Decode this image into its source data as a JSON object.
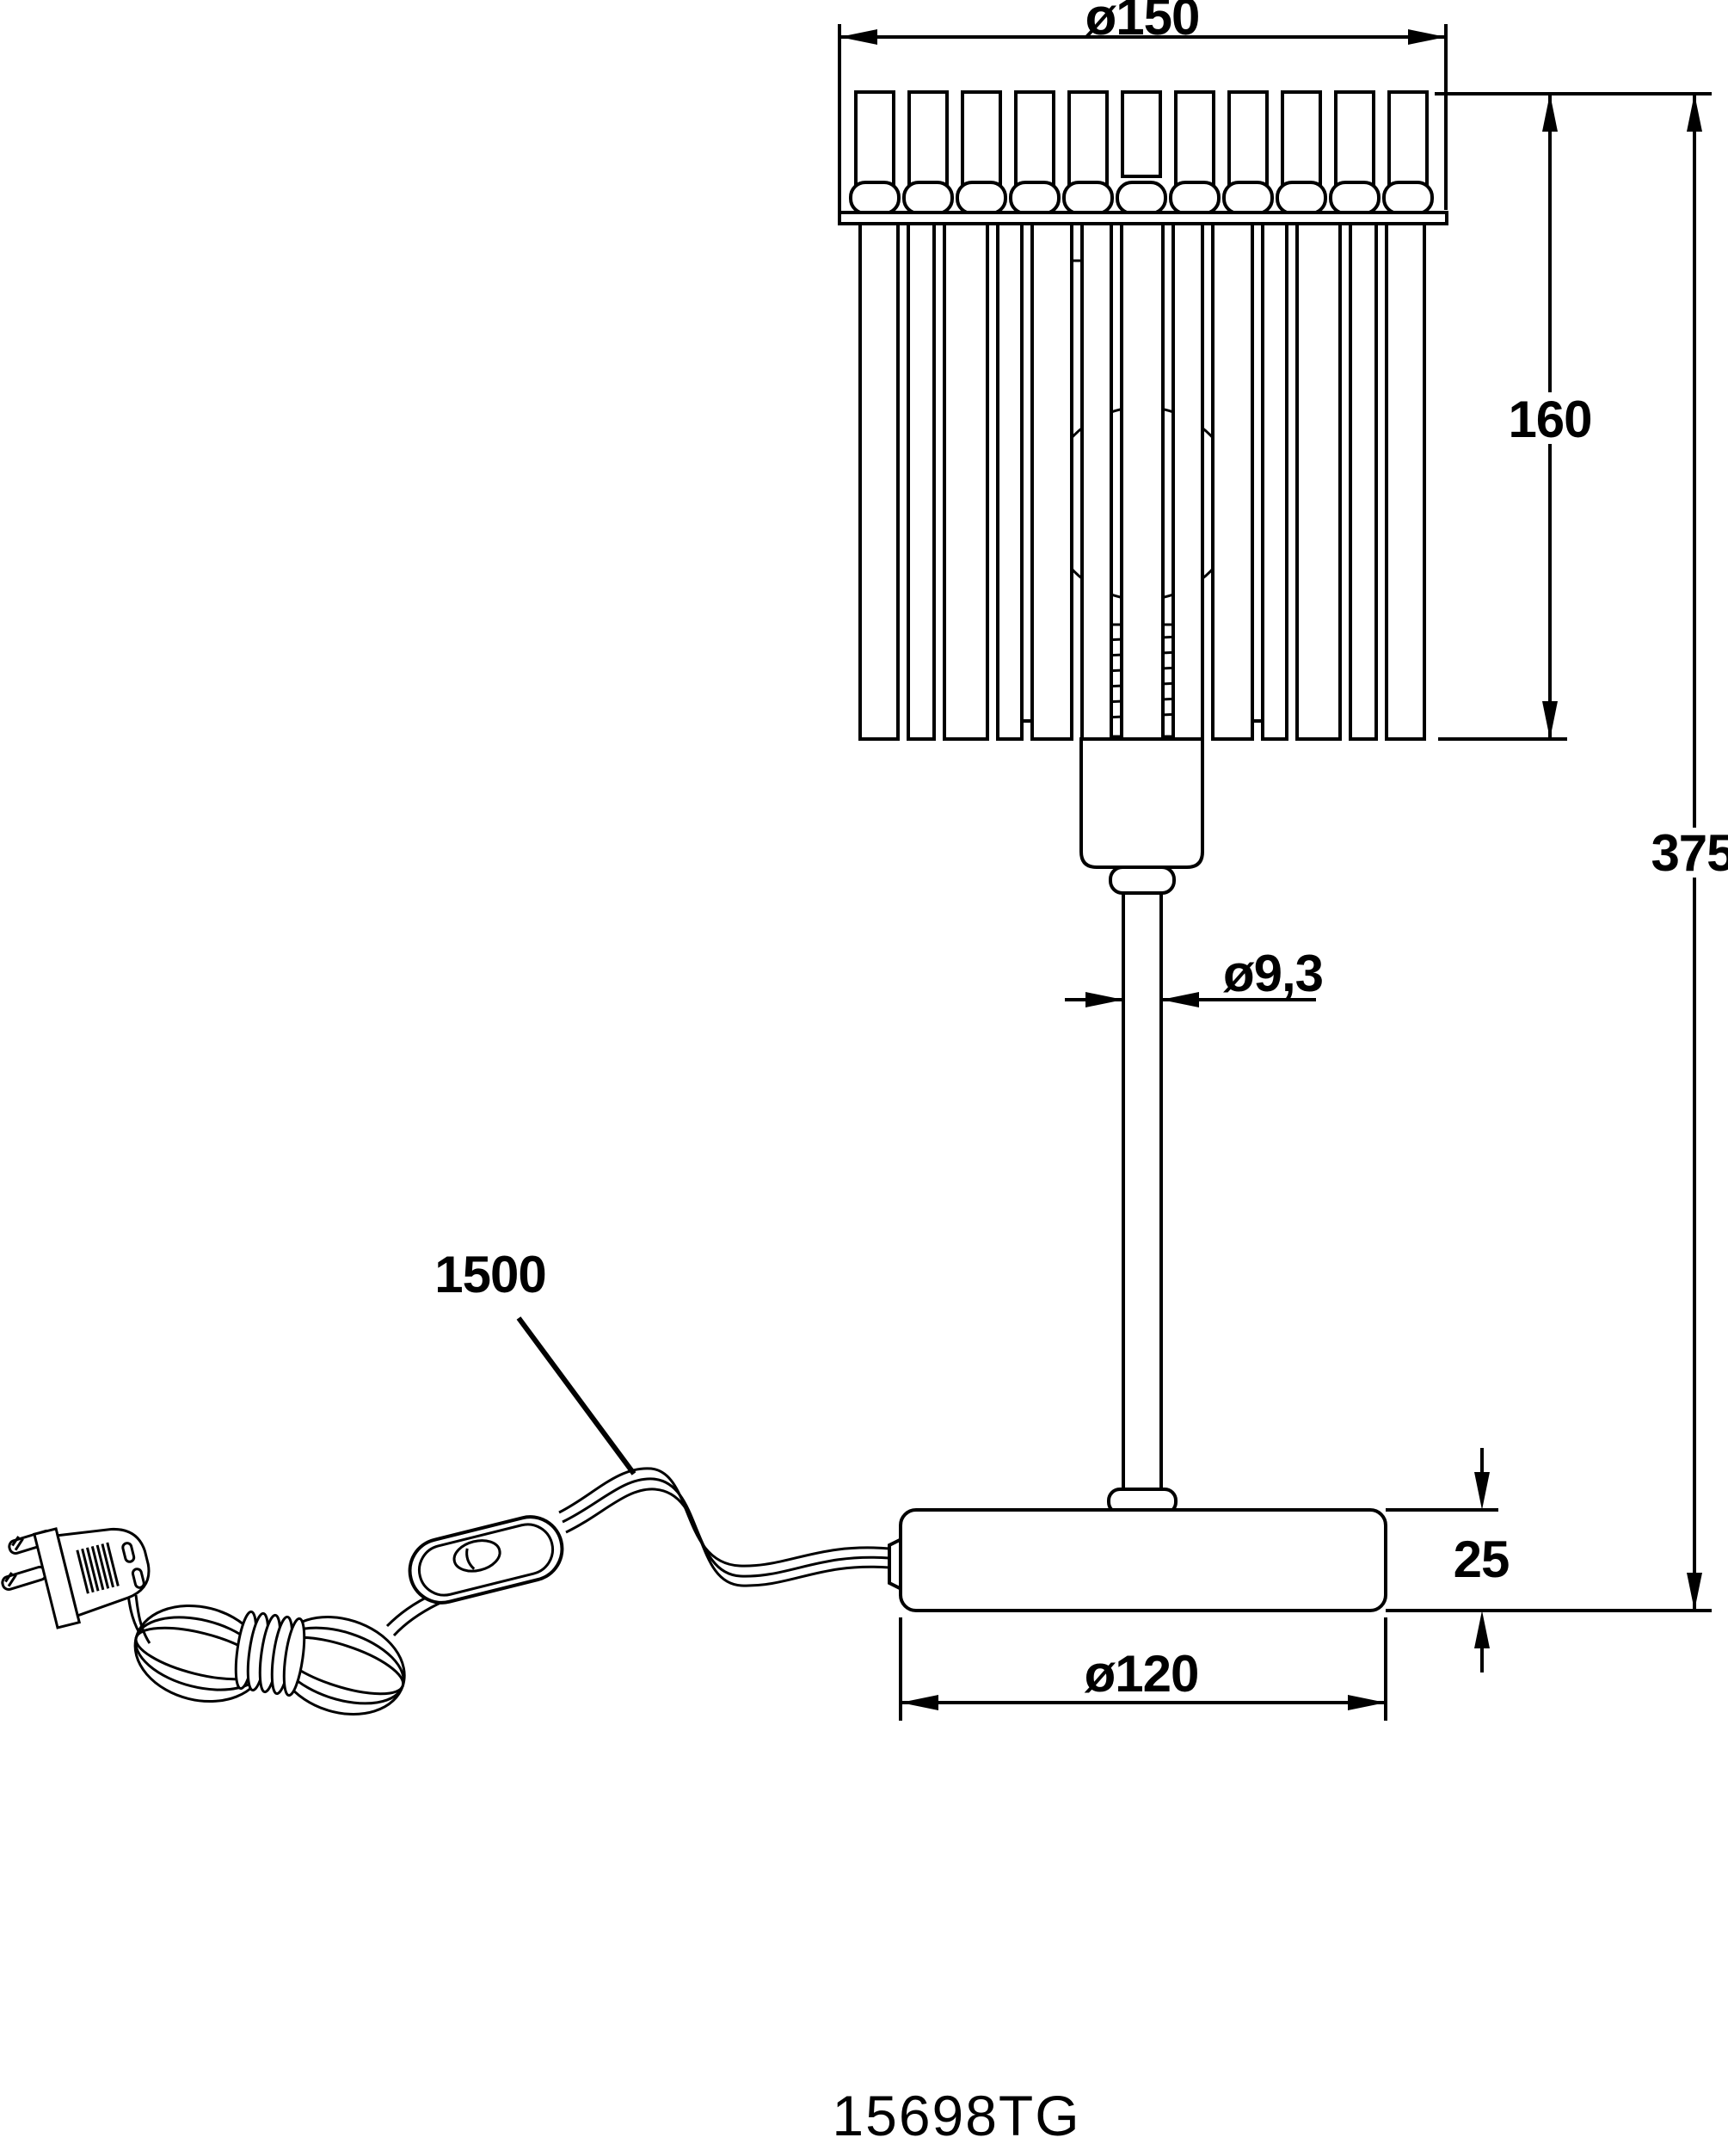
{
  "part_number": "15698TG",
  "colors": {
    "line": "#000000",
    "background": "#ffffff"
  },
  "dimension_labels": {
    "shade_diameter": "ø150",
    "shade_height": "160",
    "total_height": "375",
    "stem_diameter": "ø9,3",
    "cable_length": "1500",
    "base_height": "25",
    "base_diameter": "ø120"
  }
}
